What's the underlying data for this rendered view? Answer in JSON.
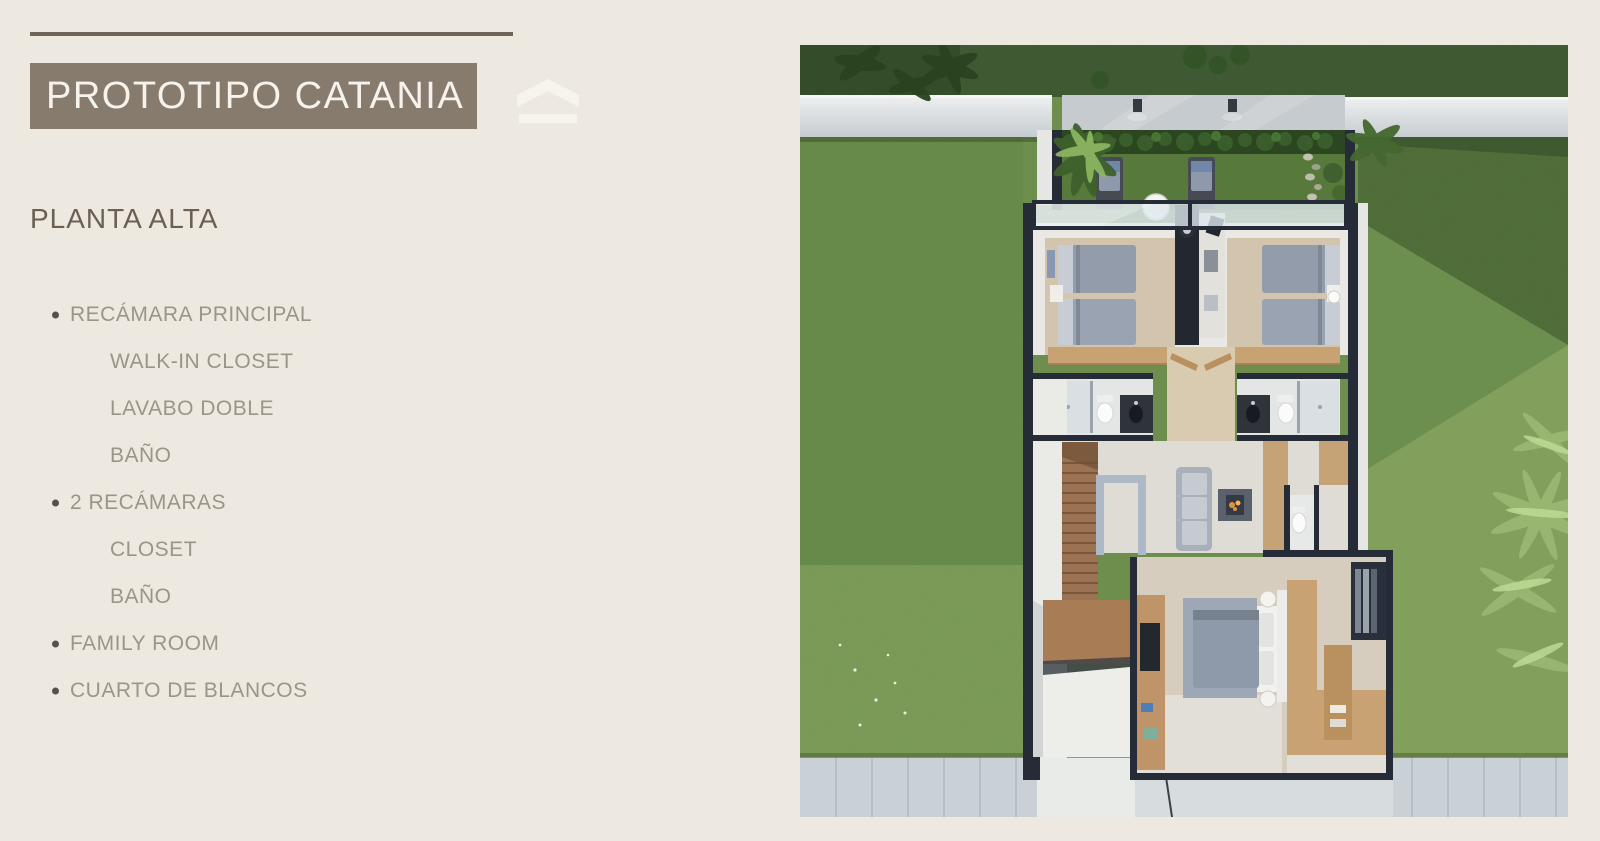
{
  "page": {
    "bg": "#EDE9E1"
  },
  "header": {
    "rule_color": "#6E6458",
    "banner_label": "PROTOTIPO CATANIA",
    "banner_bg": "#877B6E",
    "banner_text_color": "#F6F3EC",
    "logo_color": "#F7F4EC"
  },
  "section_title": "PLANTA ALTA",
  "text_colors": {
    "heading": "#6B5F52",
    "list": "#9B9489",
    "bullet": "#57514A"
  },
  "features": [
    {
      "label": "RECÁMARA PRINCIPAL",
      "level": 1
    },
    {
      "label": "WALK-IN CLOSET",
      "level": 2
    },
    {
      "label": "LAVABO DOBLE",
      "level": 2
    },
    {
      "label": "BAÑO",
      "level": 2
    },
    {
      "label": "2 RECÁMARAS",
      "level": 1
    },
    {
      "label": "CLOSET",
      "level": 2
    },
    {
      "label": "BAÑO",
      "level": 2
    },
    {
      "label": "FAMILY ROOM",
      "level": 1
    },
    {
      "label": "CUARTO DE BLANCOS",
      "level": 1
    }
  ],
  "floorplan": {
    "palette": {
      "grass": "#6E8E4E",
      "grass_dark": "#3C5531",
      "hedge": "#2B4621",
      "wall_light": "#E8EAEA",
      "wall_dark": "#262C37",
      "wood": "#C9A273",
      "stair_wood": "#9B7252",
      "floor": "#DFDCD5",
      "bedroom_floor": "#D3C5AD",
      "bed": "#929CAB",
      "sofa": "#AEB5BE",
      "rug": "#98A3B4",
      "flame": "#E0913F",
      "sidewalk": "#C9D0D6",
      "glass": "#DFE9EF"
    }
  }
}
